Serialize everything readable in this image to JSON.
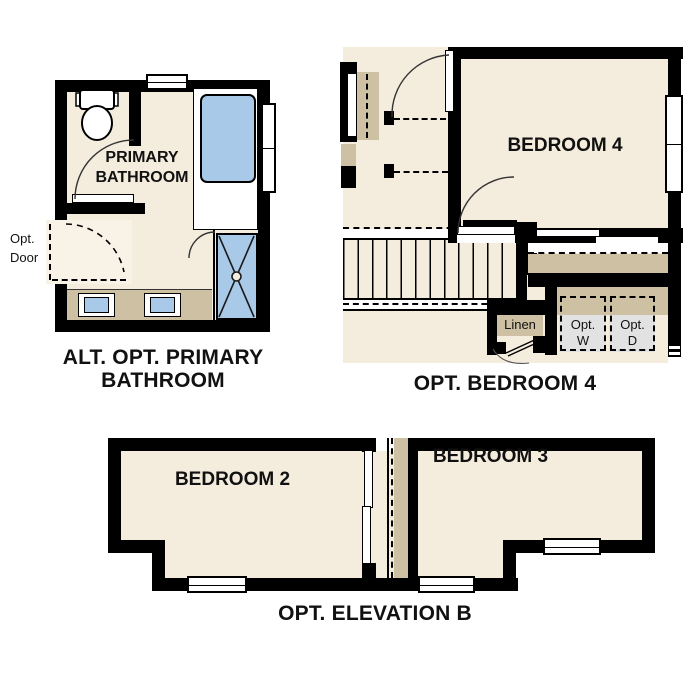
{
  "colors": {
    "floor_cream": "#f4ecdd",
    "floor_cream_light": "#f9f3e7",
    "counter_tan": "#cdc0a3",
    "fixture_blue": "#a9c9e8",
    "appliance_gray": "#e2e2e2",
    "wall_black": "#000000",
    "text": "#111111"
  },
  "plans": {
    "bathroom": {
      "caption_line1": "ALT. OPT. PRIMARY",
      "caption_line2": "BATHROOM",
      "room_label_line1": "PRIMARY",
      "room_label_line2": "BATHROOM",
      "opt_door_line1": "Opt.",
      "opt_door_line2": "Door"
    },
    "bedroom4": {
      "caption": "OPT. BEDROOM 4",
      "room_label": "BEDROOM 4",
      "linen_label": "Linen",
      "washer_line1": "Opt.",
      "washer_line2": "W",
      "dryer_line1": "Opt.",
      "dryer_line2": "D"
    },
    "elevation_b": {
      "caption": "OPT. ELEVATION B",
      "bedroom2_label": "BEDROOM 2",
      "bedroom3_label": "BEDROOM 3"
    }
  }
}
